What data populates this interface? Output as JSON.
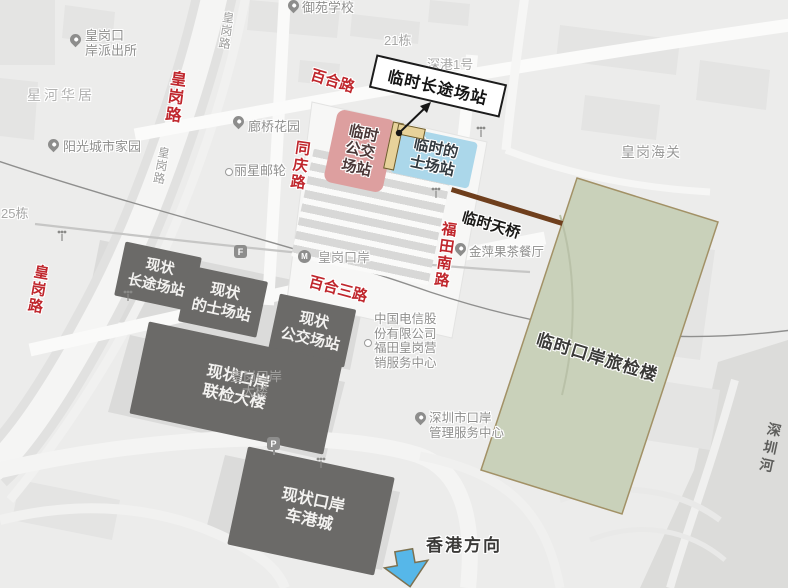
{
  "colors": {
    "red_label": "#c0272d",
    "pink_box": "#dd9f9f",
    "blue_box": "#abd7ea",
    "dark_box": "#6b6a68",
    "green_area": "#c9d1ba",
    "green_border": "#a29166",
    "bridge_brown": "#6f3f1d",
    "arrow_blue": "#56b7e9"
  },
  "red_road_labels": [
    {
      "text": "皇岗路"
    },
    {
      "text": "百合路"
    },
    {
      "text": "同庆路"
    },
    {
      "text": "百合三路"
    },
    {
      "text": "福田南路"
    },
    {
      "text": "皇岗路"
    }
  ],
  "gray_road_labels": [
    {
      "text": "皇岗路"
    },
    {
      "text": "皇岗路"
    }
  ],
  "pois": [
    {
      "lines": [
        "皇岗口",
        "岸派出所"
      ]
    },
    {
      "lines": [
        "星河华居"
      ]
    },
    {
      "lines": [
        "阳光城市家园"
      ]
    },
    {
      "lines": [
        "御苑学校"
      ]
    },
    {
      "lines": [
        "21栋"
      ]
    },
    {
      "lines": [
        "深港1号"
      ]
    },
    {
      "lines": [
        "25栋"
      ]
    },
    {
      "lines": [
        "廊桥花园"
      ]
    },
    {
      "lines": [
        "丽星邮轮"
      ]
    },
    {
      "lines": [
        "皇岗海关"
      ]
    },
    {
      "lines": [
        "金萍果茶餐厅"
      ]
    },
    {
      "lines": [
        "中国电信股",
        "份有限公司",
        "福田皇岗营",
        "销服务中心"
      ]
    },
    {
      "lines": [
        "深圳市口岸",
        "管理服务中心"
      ]
    },
    {
      "lines": [
        "皇岗口岸"
      ]
    },
    {
      "lines": [
        "皇岗口岸",
        "大楼"
      ]
    },
    {
      "lines": [
        "深圳河"
      ]
    }
  ],
  "temporary": {
    "coach_station": {
      "label": "临时长途场站"
    },
    "bus_station": {
      "lines": [
        "临时",
        "公交",
        "场站"
      ]
    },
    "taxi_station": {
      "lines": [
        "临时的",
        "士场站"
      ]
    },
    "footbridge": {
      "label": "临时天桥"
    },
    "inspection_hall": {
      "label": "临时口岸旅检楼"
    }
  },
  "existing_facilities": [
    {
      "lines": [
        "现状",
        "长途场站"
      ]
    },
    {
      "lines": [
        "现状",
        "的士场站"
      ]
    },
    {
      "lines": [
        "现状",
        "公交场站"
      ]
    },
    {
      "lines": [
        "现状口岸",
        "联检大楼"
      ]
    },
    {
      "lines": [
        "现状口岸",
        "车港城"
      ]
    }
  ],
  "direction_label": "香港方向",
  "icons": {
    "metro": "M",
    "exit": "F",
    "parking": "P"
  }
}
